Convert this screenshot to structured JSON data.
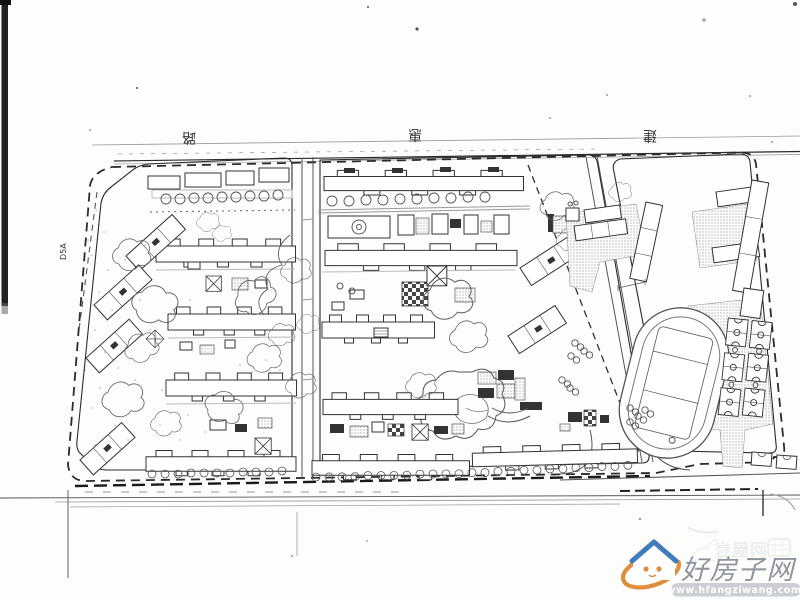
{
  "scan": {
    "paper_color": "#fdfdfc",
    "ink_color": "#2b2b2b",
    "scanner_edge_color": "#222222"
  },
  "plan": {
    "street_labels": [
      {
        "char": "路"
      },
      {
        "char": "惠"
      },
      {
        "char": "建"
      }
    ],
    "parcel_label": "D5A",
    "features": [
      "west-residential-parcel",
      "center-residential-parcel",
      "east-school-parcel",
      "running-track",
      "basketball-courts",
      "site-boundary-dashed",
      "tree-clusters",
      "pond-garden"
    ]
  },
  "watermark": {
    "brand": "好房子网",
    "url": "www.hfangziwang.com",
    "faint_brand": "吉屋网",
    "colors": {
      "roof_blue": "#3e7cba",
      "swoosh_orange": "#e08d3e",
      "brand_text": "#8d949d",
      "url_strip_bg": "#c7cbd0",
      "url_text": "#ffffff"
    }
  }
}
